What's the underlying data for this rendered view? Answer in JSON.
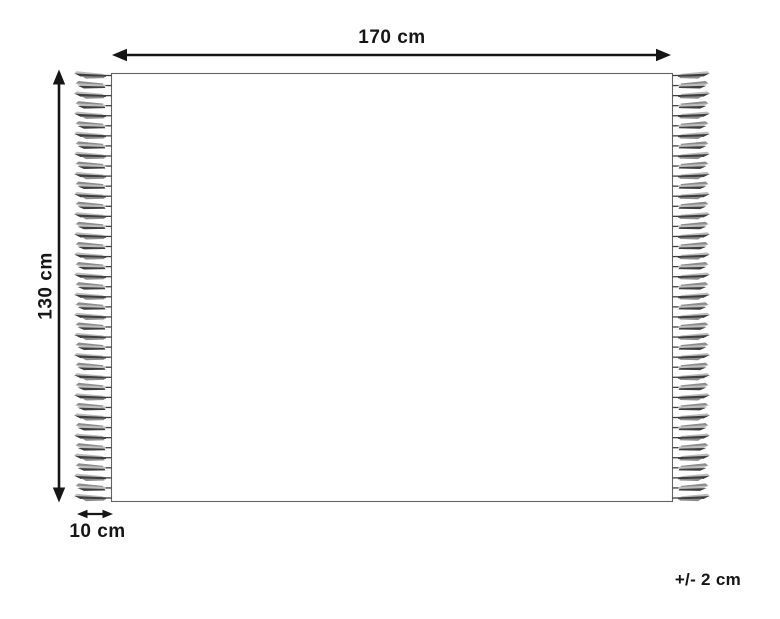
{
  "diagram": {
    "labels": {
      "width": "170 cm",
      "height": "130 cm",
      "fringe_length": "10 cm",
      "tolerance": "+/- 2 cm"
    },
    "fringe": {
      "tassels_per_side": 43,
      "sides": [
        "left",
        "right"
      ]
    },
    "colors": {
      "background": "#ffffff",
      "line": "#161616",
      "rug_outline": "#636363",
      "tassel_dark": "#3f3f3f",
      "tassel_mid": "#8c8c8c",
      "tassel_light": "#bdbdbd"
    }
  }
}
